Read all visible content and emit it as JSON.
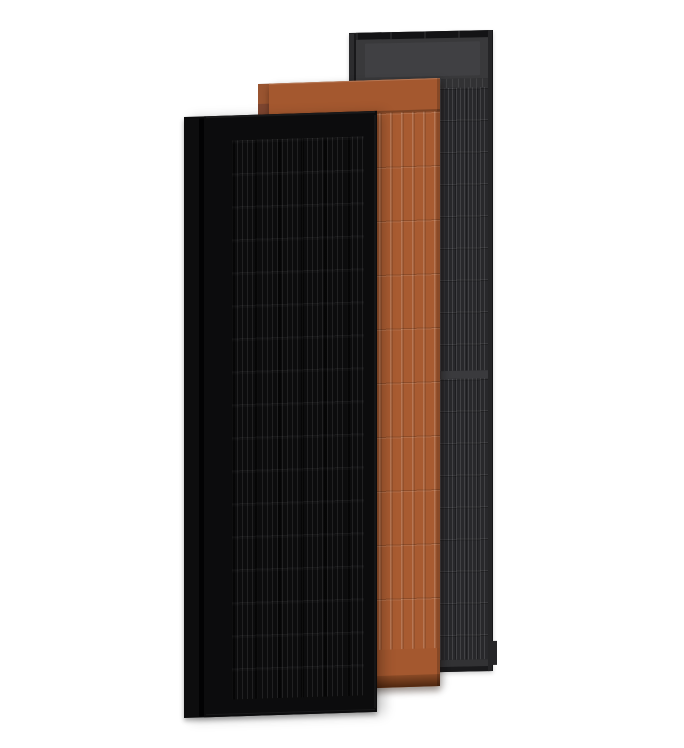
{
  "scene": {
    "type": "product-render",
    "subject": "three overlapping vertical solar panels on white background",
    "panels": [
      {
        "id": "black",
        "finish": "matte black",
        "stack": "front"
      },
      {
        "id": "terracotta",
        "finish": "terracotta",
        "stack": "middle"
      },
      {
        "id": "anthracite",
        "finish": "anthracite grey",
        "stack": "back"
      }
    ]
  },
  "palette": {
    "bg": "#ffffff",
    "blk-frame": "#0b0b0c",
    "blk-body": "#0c0c0d",
    "blk-rail": "#0d0d0e",
    "ter-body": "#a85b31",
    "ter-header": "#a4582f",
    "ter-divider": "#7b4324",
    "ter-deep": "#4f2710",
    "ter-tab": "#6b4136",
    "ant-frame": "#202022",
    "ant-body": "#28282b",
    "ant-header": "#39393b",
    "ant-strip": "#131315",
    "ant-divider": "#3a3a3d",
    "ant-band": "#323234",
    "ant-rail": "#2c2c2e"
  }
}
